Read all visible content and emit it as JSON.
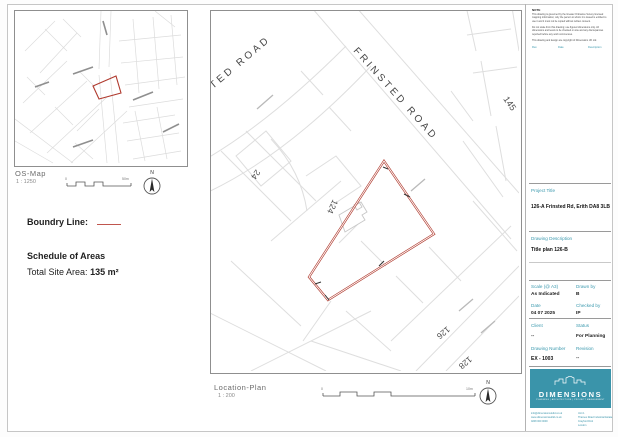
{
  "sheet": {
    "accent": "#3a94aa",
    "boundary_color": "#b03a2e"
  },
  "os_map": {
    "label": "OS-Map",
    "scale_text": "1 : 1250",
    "scale_start": "0",
    "scale_end": "50m",
    "north_label": "N"
  },
  "legend": {
    "boundary_label": "Boundry Line:",
    "schedule_title": "Schedule of Areas",
    "total_area_label": "Total Site Area:",
    "total_area_value": "135 m²"
  },
  "location_plan": {
    "label": "Location-Plan",
    "scale_text": "1 : 200",
    "scale_start": "0",
    "scale_end": "10m",
    "north_label": "N",
    "road_label_main": "FRINSTED ROAD",
    "road_label_partial": "TED ROAD",
    "plot_numbers": [
      "145",
      "24",
      "124",
      "126",
      "128"
    ]
  },
  "title_block": {
    "notes_heading": "NOTE",
    "notes": [
      "This drawing is governed by the Greater Ordnance Survey licensed mapping information; only the person to whom it is issued is entitled to use it and it must not be copied without written consent.",
      "Do not scale from this drawing; use figured dimensions only. All dimensions and levels to be checked on site and any discrepancies reported before any work commences.",
      "This drawing and design are copyright of Dimensions UK Ltd."
    ],
    "revision_header": {
      "rev": "Rev",
      "date": "Date",
      "description": "Description"
    },
    "project_title_label": "Project Title",
    "project_title_value": "126-A Frinsted Rd, Erith DA8 3LB",
    "drawing_description_label": "Drawing Description",
    "drawing_description_value": "Title plan 126-B",
    "fields": [
      {
        "label": "Scale (@ A3)",
        "value": "As Indicated"
      },
      {
        "label": "Drawn by",
        "value": "B"
      },
      {
        "label": "Date",
        "value": "04 07 2025"
      },
      {
        "label": "Checked by",
        "value": "IP"
      },
      {
        "label": "Client",
        "value": "--"
      },
      {
        "label": "Status",
        "value": "For Planning"
      },
      {
        "label": "Drawing Number",
        "value": "EX - 1003"
      },
      {
        "label": "Revision",
        "value": "--"
      }
    ],
    "logo": {
      "name": "DIMENSIONS",
      "tagline": "PLANNING | ARCHITECTURE | PROJECT MANAGEMENT",
      "contact_left": [
        "info@dimensionsukltd.co.uk",
        "www.dimensionsukltd.co.uk",
        "0208 000 0000"
      ],
      "contact_right": [
        "Unit 1",
        "Thames Road Industrial Estate",
        "Crayford DA1",
        "London"
      ]
    }
  }
}
